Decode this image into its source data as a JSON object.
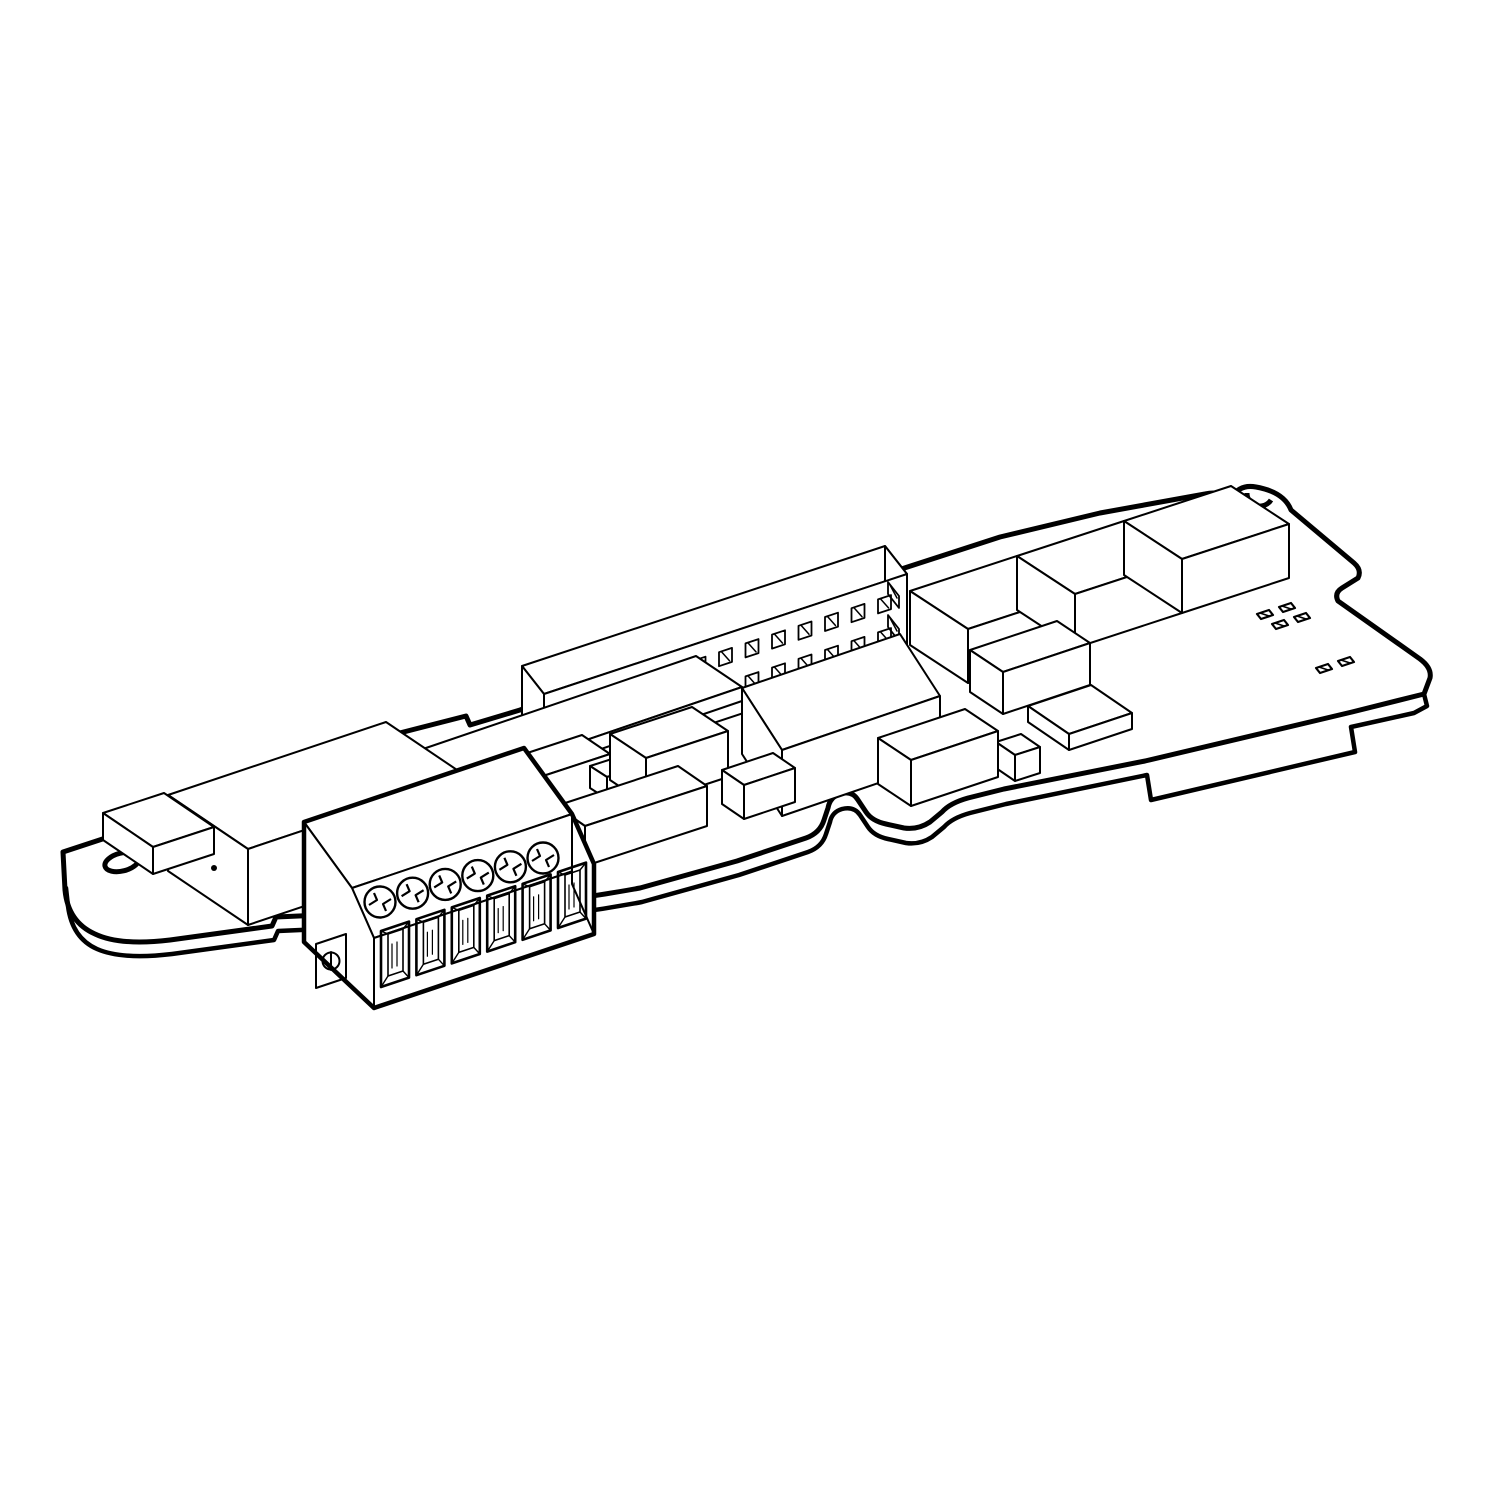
{
  "figure": {
    "subject": "Isometric technical line drawing of a plug-in option circuit board with screw terminal block",
    "style": "black outline on white, no text labels",
    "background_color": "#ffffff",
    "line_color": "#000000",
    "fill_color": "#ffffff"
  },
  "board": {
    "mounting_tab": {
      "holes": 1,
      "edge_notch_count": 1
    },
    "top_edge_bumps": 2,
    "right_ear_half_holes": 1,
    "bottom_edge_cutout": "double-hump S curve",
    "underside_edge_tabs": 1
  },
  "terminal_block": {
    "screws": 6,
    "wire_cavities": 6,
    "captive_screws": 1
  },
  "pin_header": {
    "rows": 2,
    "columns": 13,
    "end_holes": 2
  },
  "components": {
    "large_boxes": 3,
    "medium_and_small_boxes": 13,
    "smd_pad_groups": [
      4,
      2
    ],
    "cover_box_dots": 1
  }
}
